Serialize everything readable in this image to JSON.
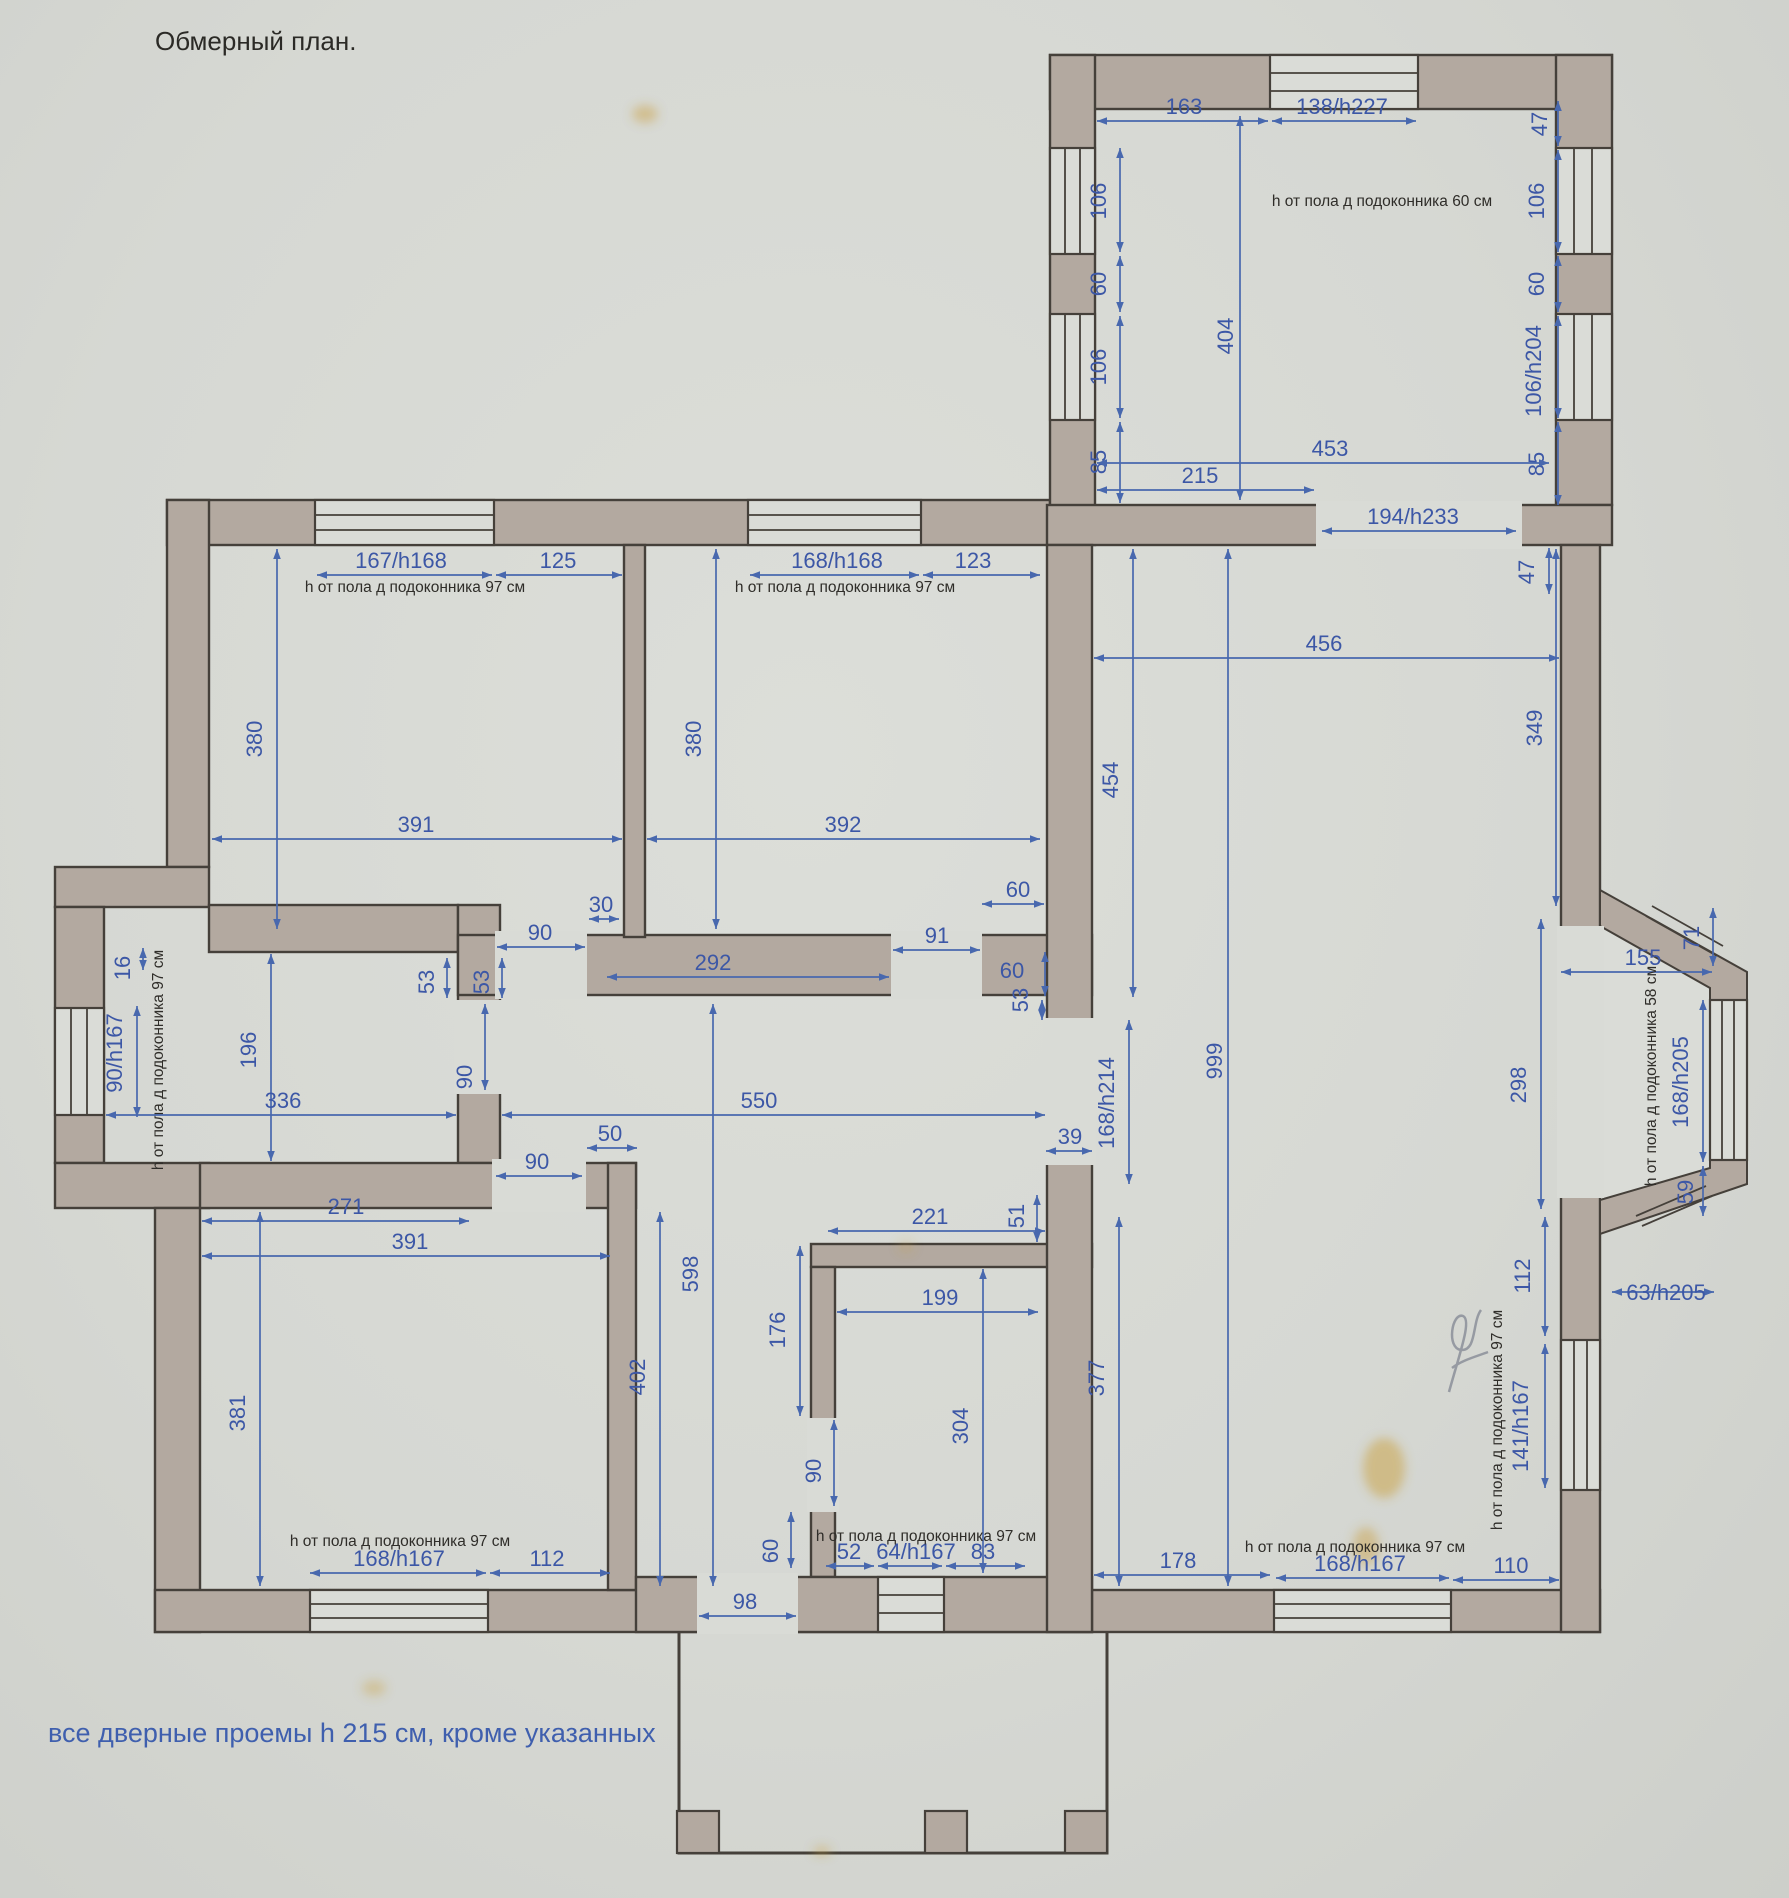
{
  "title": "Обмерный план.",
  "footnote": "все дверные проемы h 215 см, кроме указанных",
  "colors": {
    "paper": "#d9dbd6",
    "wall_fill": "#b3a9a0",
    "wall_line": "#45403a",
    "dim_blue": "#3c57a6",
    "note_black": "#2f2d29"
  },
  "units": "см",
  "dimensions": [
    {
      "t": "163",
      "x": 1184,
      "y": 114,
      "l": [
        1097,
        121,
        1268,
        121
      ]
    },
    {
      "t": "138/h227",
      "x": 1342,
      "y": 114,
      "l": [
        1272,
        121,
        1416,
        121
      ]
    },
    {
      "t": "47",
      "x": 1547,
      "y": 124,
      "r": 90,
      "l": [
        1558,
        101,
        1558,
        146
      ]
    },
    {
      "t": "h от пола д подоконника 60 см",
      "x": 1382,
      "y": 206,
      "k": "note"
    },
    {
      "t": "106",
      "x": 1106,
      "y": 201,
      "r": 90,
      "l": [
        1120,
        148,
        1120,
        252
      ]
    },
    {
      "t": "60",
      "x": 1106,
      "y": 284,
      "r": 90,
      "l": [
        1120,
        256,
        1120,
        312
      ]
    },
    {
      "t": "106",
      "x": 1106,
      "y": 367,
      "r": 90,
      "l": [
        1120,
        316,
        1120,
        418
      ]
    },
    {
      "t": "85",
      "x": 1106,
      "y": 462,
      "r": 90,
      "l": [
        1120,
        422,
        1120,
        503
      ]
    },
    {
      "t": "404",
      "x": 1233,
      "y": 336,
      "r": 90,
      "l": [
        1240,
        116,
        1240,
        500
      ]
    },
    {
      "t": "106",
      "x": 1544,
      "y": 201,
      "r": 90,
      "l": [
        1558,
        150,
        1558,
        252
      ]
    },
    {
      "t": "60",
      "x": 1544,
      "y": 284,
      "r": 90,
      "l": [
        1558,
        256,
        1558,
        312
      ]
    },
    {
      "t": "106/h204",
      "x": 1541,
      "y": 371,
      "r": 90,
      "l": [
        1558,
        316,
        1558,
        418
      ]
    },
    {
      "t": "85",
      "x": 1544,
      "y": 464,
      "r": 90,
      "l": [
        1558,
        422,
        1558,
        505
      ]
    },
    {
      "t": "453",
      "x": 1330,
      "y": 456,
      "l": [
        1097,
        463,
        1549,
        463
      ]
    },
    {
      "t": "215",
      "x": 1200,
      "y": 483,
      "l": [
        1097,
        490,
        1314,
        490
      ]
    },
    {
      "t": "194/h233",
      "x": 1413,
      "y": 524,
      "l": [
        1322,
        531,
        1516,
        531
      ]
    },
    {
      "t": "47",
      "x": 1534,
      "y": 572,
      "r": 90,
      "l": [
        1549,
        548,
        1549,
        594
      ]
    },
    {
      "t": "456",
      "x": 1324,
      "y": 651,
      "l": [
        1094,
        658,
        1559,
        658
      ]
    },
    {
      "t": "454",
      "x": 1118,
      "y": 780,
      "r": 90,
      "l": [
        1133,
        549,
        1133,
        997
      ]
    },
    {
      "t": "349",
      "x": 1542,
      "y": 728,
      "r": 90,
      "l": [
        1556,
        549,
        1556,
        906
      ]
    },
    {
      "t": "999",
      "x": 1222,
      "y": 1061,
      "r": 90,
      "l": [
        1228,
        549,
        1228,
        1586
      ]
    },
    {
      "t": "298",
      "x": 1526,
      "y": 1085,
      "r": 90,
      "l": [
        1541,
        919,
        1541,
        1209
      ]
    },
    {
      "t": "112",
      "x": 1530,
      "y": 1276,
      "r": 90,
      "l": [
        1545,
        1217,
        1545,
        1336
      ]
    },
    {
      "t": "377",
      "x": 1104,
      "y": 1378,
      "r": 90,
      "l": [
        1119,
        1217,
        1119,
        1586
      ]
    },
    {
      "t": "155",
      "x": 1643,
      "y": 965,
      "l": [
        1561,
        972,
        1712,
        972
      ]
    },
    {
      "t": "71",
      "x": 1699,
      "y": 938,
      "r": 90,
      "l": [
        1713,
        908,
        1713,
        966
      ]
    },
    {
      "t": "168/h205",
      "x": 1688,
      "y": 1082,
      "r": 90,
      "l": [
        1703,
        1000,
        1703,
        1162
      ]
    },
    {
      "t": "59",
      "x": 1693,
      "y": 1192,
      "r": 90,
      "l": [
        1703,
        1166,
        1703,
        1216
      ]
    },
    {
      "t": "h от пола д подоконника 58 см",
      "x": 1656,
      "y": 1076,
      "r": 90,
      "k": "note"
    },
    {
      "t": "63/h205",
      "x": 1666,
      "y": 1300,
      "l": [
        1612,
        1292,
        1714,
        1292
      ]
    },
    {
      "t": "168/h214",
      "x": 1114,
      "y": 1103,
      "r": 90,
      "l": [
        1129,
        1020,
        1129,
        1184
      ]
    },
    {
      "t": "39",
      "x": 1070,
      "y": 1144,
      "l": [
        1046,
        1151,
        1092,
        1151
      ]
    },
    {
      "t": "60",
      "x": 1018,
      "y": 897,
      "l": [
        982,
        904,
        1044,
        904
      ]
    },
    {
      "t": "60",
      "x": 1012,
      "y": 978,
      "l": [
        1045,
        952,
        1045,
        996
      ]
    },
    {
      "t": "53",
      "x": 1028,
      "y": 1000,
      "r": 90,
      "l": [
        1042,
        1000,
        1042,
        1020
      ]
    },
    {
      "t": "178",
      "x": 1178,
      "y": 1568,
      "l": [
        1094,
        1575,
        1270,
        1575
      ]
    },
    {
      "t": "168/h167",
      "x": 1360,
      "y": 1571,
      "l": [
        1276,
        1578,
        1449,
        1578
      ]
    },
    {
      "t": "110",
      "x": 1511,
      "y": 1573,
      "l": [
        1453,
        1580,
        1559,
        1580
      ]
    },
    {
      "t": "h от пола д подоконника 97 см",
      "x": 1355,
      "y": 1552,
      "k": "note"
    },
    {
      "t": "141/h167",
      "x": 1528,
      "y": 1426,
      "r": 90,
      "l": [
        1545,
        1344,
        1545,
        1488
      ]
    },
    {
      "t": "h от пола д подоконника 97 см",
      "x": 1502,
      "y": 1420,
      "r": 90,
      "k": "note"
    },
    {
      "t": "167/h168",
      "x": 401,
      "y": 568,
      "l": [
        317,
        575,
        492,
        575
      ]
    },
    {
      "t": "125",
      "x": 558,
      "y": 568,
      "l": [
        496,
        575,
        622,
        575
      ]
    },
    {
      "t": "h от пола д подоконника 97 см",
      "x": 415,
      "y": 592,
      "k": "note"
    },
    {
      "t": "380",
      "x": 262,
      "y": 739,
      "r": 90,
      "l": [
        277,
        549,
        277,
        929
      ]
    },
    {
      "t": "391",
      "x": 416,
      "y": 832,
      "l": [
        212,
        839,
        622,
        839
      ]
    },
    {
      "t": "168/h168",
      "x": 837,
      "y": 568,
      "l": [
        750,
        575,
        919,
        575
      ]
    },
    {
      "t": "123",
      "x": 973,
      "y": 568,
      "l": [
        923,
        575,
        1040,
        575
      ]
    },
    {
      "t": "h от пола д подоконника 97 см",
      "x": 845,
      "y": 592,
      "k": "note"
    },
    {
      "t": "380",
      "x": 701,
      "y": 739,
      "r": 90,
      "l": [
        716,
        549,
        716,
        929
      ]
    },
    {
      "t": "392",
      "x": 843,
      "y": 832,
      "l": [
        647,
        839,
        1040,
        839
      ]
    },
    {
      "t": "30",
      "x": 601,
      "y": 912,
      "l": [
        589,
        919,
        619,
        919
      ]
    },
    {
      "t": "90",
      "x": 540,
      "y": 940,
      "l": [
        497,
        947,
        585,
        947
      ]
    },
    {
      "t": "292",
      "x": 713,
      "y": 970,
      "l": [
        607,
        977,
        889,
        977
      ]
    },
    {
      "t": "91",
      "x": 937,
      "y": 943,
      "l": [
        893,
        950,
        980,
        950
      ]
    },
    {
      "t": "53",
      "x": 434,
      "y": 982,
      "r": 90,
      "l": [
        447,
        958,
        447,
        998
      ]
    },
    {
      "t": "53",
      "x": 489,
      "y": 982,
      "r": 90,
      "l": [
        502,
        958,
        502,
        998
      ]
    },
    {
      "t": "16",
      "x": 130,
      "y": 968,
      "r": 90,
      "l": [
        143,
        948,
        143,
        970
      ]
    },
    {
      "t": "90/h167",
      "x": 122,
      "y": 1053,
      "r": 90,
      "l": [
        137,
        1006,
        137,
        1117
      ]
    },
    {
      "t": "h от пола д подоконника 97 см",
      "x": 163,
      "y": 1060,
      "r": 90,
      "k": "note"
    },
    {
      "t": "196",
      "x": 256,
      "y": 1050,
      "r": 90,
      "l": [
        271,
        954,
        271,
        1161
      ]
    },
    {
      "t": "336",
      "x": 283,
      "y": 1108,
      "l": [
        106,
        1115,
        456,
        1115
      ]
    },
    {
      "t": "90",
      "x": 472,
      "y": 1077,
      "r": 90,
      "l": [
        485,
        1004,
        485,
        1090
      ]
    },
    {
      "t": "550",
      "x": 759,
      "y": 1108,
      "l": [
        502,
        1115,
        1045,
        1115
      ]
    },
    {
      "t": "50",
      "x": 610,
      "y": 1141,
      "l": [
        587,
        1148,
        637,
        1148
      ]
    },
    {
      "t": "90",
      "x": 537,
      "y": 1169,
      "l": [
        496,
        1176,
        582,
        1176
      ]
    },
    {
      "t": "271",
      "x": 346,
      "y": 1214,
      "l": [
        202,
        1221,
        469,
        1221
      ]
    },
    {
      "t": "391",
      "x": 410,
      "y": 1249,
      "l": [
        202,
        1256,
        610,
        1256
      ]
    },
    {
      "t": "381",
      "x": 245,
      "y": 1413,
      "r": 90,
      "l": [
        260,
        1212,
        260,
        1586
      ]
    },
    {
      "t": "598",
      "x": 698,
      "y": 1274,
      "r": 90,
      "l": [
        713,
        1004,
        713,
        1586
      ]
    },
    {
      "t": "402",
      "x": 645,
      "y": 1377,
      "r": 90,
      "l": [
        660,
        1212,
        660,
        1586
      ]
    },
    {
      "t": "h от пола д подоконника 97 см",
      "x": 400,
      "y": 1546,
      "k": "note"
    },
    {
      "t": "168/h167",
      "x": 399,
      "y": 1566,
      "l": [
        310,
        1573,
        486,
        1573
      ]
    },
    {
      "t": "112",
      "x": 547,
      "y": 1566,
      "l": [
        490,
        1573,
        610,
        1573
      ]
    },
    {
      "t": "221",
      "x": 930,
      "y": 1224,
      "l": [
        828,
        1231,
        1045,
        1231
      ]
    },
    {
      "t": "51",
      "x": 1024,
      "y": 1216,
      "r": 90,
      "l": [
        1037,
        1195,
        1037,
        1242
      ]
    },
    {
      "t": "199",
      "x": 940,
      "y": 1305,
      "l": [
        837,
        1312,
        1038,
        1312
      ]
    },
    {
      "t": "304",
      "x": 968,
      "y": 1426,
      "r": 90,
      "l": [
        983,
        1269,
        983,
        1573
      ]
    },
    {
      "t": "176",
      "x": 785,
      "y": 1330,
      "r": 90,
      "l": [
        800,
        1246,
        800,
        1416
      ]
    },
    {
      "t": "90",
      "x": 821,
      "y": 1471,
      "r": 90,
      "l": [
        834,
        1420,
        834,
        1506
      ]
    },
    {
      "t": "60",
      "x": 778,
      "y": 1551,
      "r": 90,
      "l": [
        791,
        1512,
        791,
        1568
      ]
    },
    {
      "t": "52",
      "x": 849,
      "y": 1559,
      "l": [
        826,
        1566,
        874,
        1566
      ]
    },
    {
      "t": "64/h167",
      "x": 916,
      "y": 1559,
      "l": [
        878,
        1566,
        942,
        1566
      ]
    },
    {
      "t": "83",
      "x": 983,
      "y": 1559,
      "l": [
        946,
        1566,
        1025,
        1566
      ]
    },
    {
      "t": "h от пола д подоконника 97 см",
      "x": 926,
      "y": 1541,
      "k": "note"
    },
    {
      "t": "98",
      "x": 745,
      "y": 1609,
      "l": [
        699,
        1616,
        796,
        1616
      ]
    }
  ]
}
